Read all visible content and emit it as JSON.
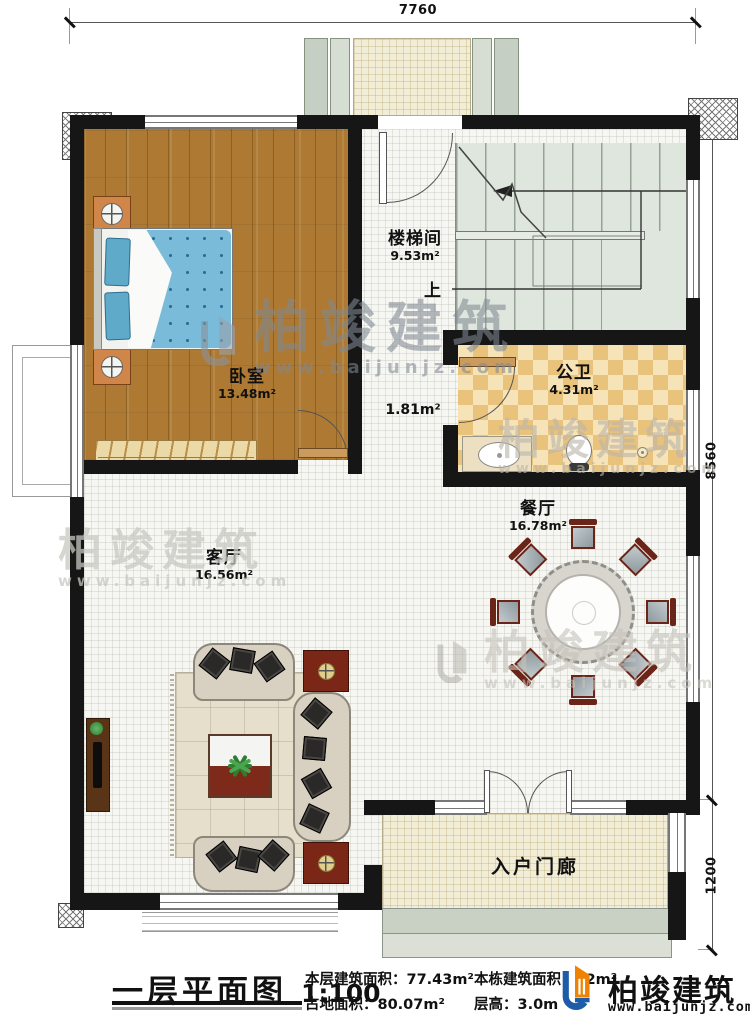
{
  "dimensions": {
    "top": "7760",
    "right_upper": "8560",
    "right_lower": "1200"
  },
  "rooms": {
    "stairwell": {
      "name": "楼梯间",
      "area": "9.53m²"
    },
    "bedroom": {
      "name": "卧室",
      "area": "13.48m²"
    },
    "bathroom": {
      "name": "公卫",
      "area": "4.31m²"
    },
    "dining": {
      "name": "餐厅",
      "area": "16.78m²"
    },
    "living": {
      "name": "客厅",
      "area": "16.56m²"
    },
    "hallway": {
      "area": "1.81m²"
    },
    "porch": {
      "name": "入户门廊"
    }
  },
  "annotations": {
    "up": "上"
  },
  "dining_set": {
    "chair_count": 8
  },
  "brand": {
    "name": "柏竣建筑",
    "url": "www.baijunjz.com"
  },
  "title_block": {
    "drawing_title": "一层平面图",
    "scale": "1:100",
    "floor_area_label": "本层建筑面积：",
    "floor_area_value": "77.43m²",
    "land_area_label": "占地面积：",
    "land_area_value": "80.07m²",
    "total_area_label": "本栋建筑面积：",
    "total_area_value": "22m²",
    "storey_height_label": "层高：",
    "storey_height_value": "3.0m"
  },
  "colors": {
    "wall": "#161616",
    "wood_floor": "#ae7a33",
    "tile_light": "#f6e3b8",
    "tile_dark": "#e9c27c",
    "stair_floor": "#dfe6de",
    "porch_floor": "#f2edd7",
    "logo_blue": "#1c5ca8",
    "logo_orange": "#ef8200"
  }
}
